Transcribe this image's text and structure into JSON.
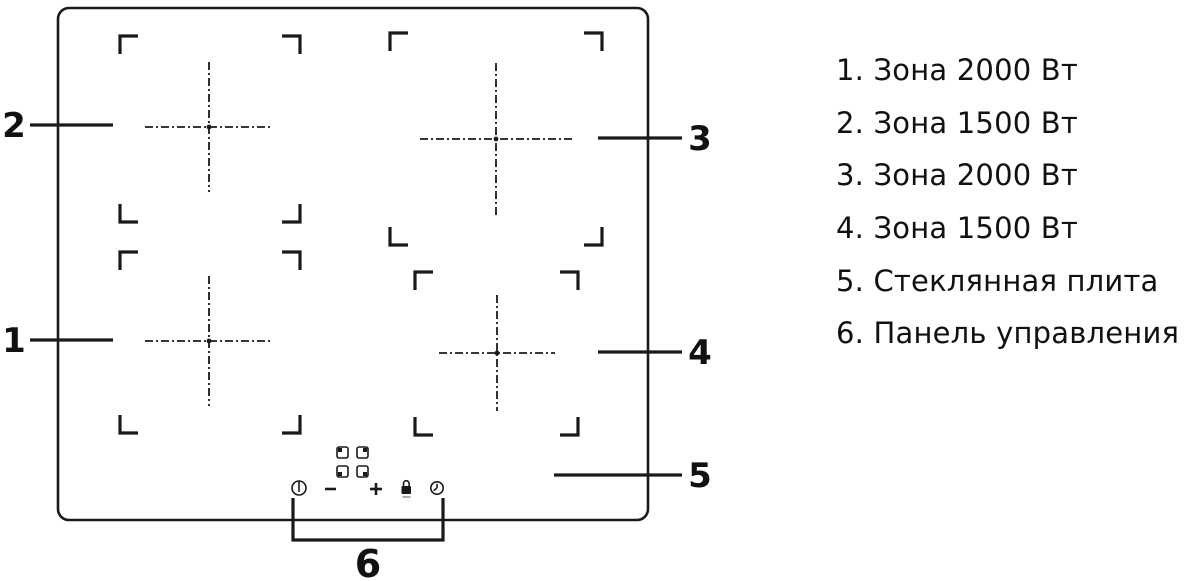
{
  "legend": {
    "items": [
      "1. Зона 2000 Вт",
      "2. Зона 1500 Вт",
      "3. Зона 2000 Вт",
      "4. Зона 1500 Вт",
      "5. Стеклянная плита",
      "6. Панель управления"
    ]
  },
  "callouts": {
    "zone1": "1",
    "zone2": "2",
    "zone3": "3",
    "zone4": "4",
    "glass": "5",
    "panel": "6"
  },
  "control_panel": {
    "icons": [
      "power-icon",
      "minus-key-icon",
      "plus-key-icon",
      "lock-icon",
      "timer-icon"
    ],
    "zone_select_keys": 4
  },
  "colors": {
    "line": "#1a1a1a",
    "background": "#ffffff"
  }
}
